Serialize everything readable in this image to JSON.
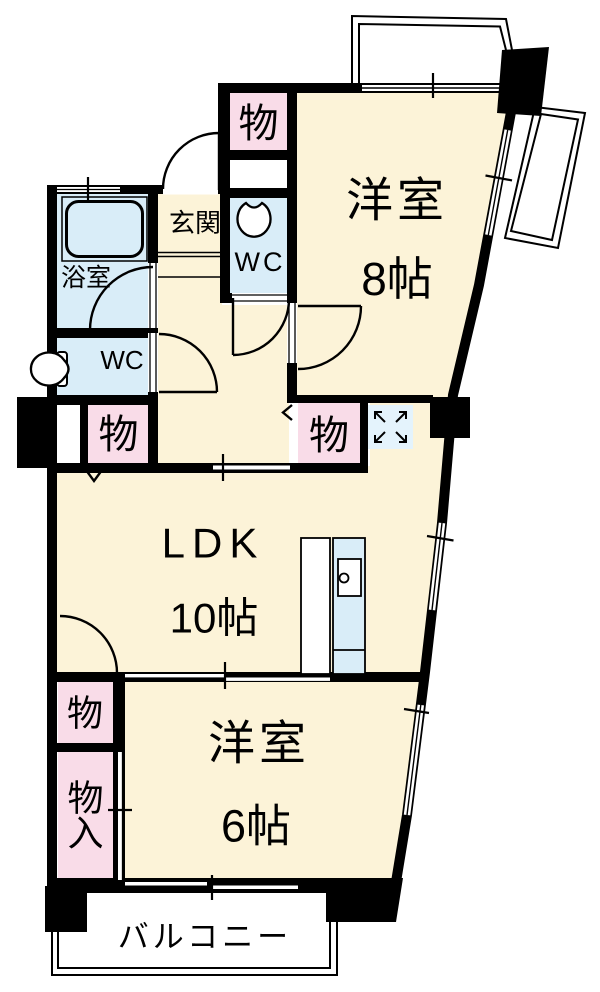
{
  "plan": {
    "type": "apartment-floor-plan",
    "colors": {
      "room_fill": "#FCF3D8",
      "wet_fill": "#D9EDF8",
      "storage_fill": "#F9DCE8",
      "vent_fill": "#E4F3FC",
      "wall": "#000000",
      "background": "#FFFFFF"
    },
    "rooms": {
      "western8": {
        "name": "洋室",
        "size": "8帖"
      },
      "ldk": {
        "name": "LDK",
        "size": "10帖"
      },
      "western6": {
        "name": "洋室",
        "size": "6帖"
      },
      "entrance": {
        "name": "玄関"
      },
      "bathroom": {
        "name": "浴室"
      },
      "toilet_top": {
        "name": "WC"
      },
      "toilet_left": {
        "name": "WC"
      },
      "balcony": {
        "name": "バルコニー"
      },
      "storage_top": {
        "name": "物"
      },
      "storage_hall": {
        "name": "物"
      },
      "storage_mid": {
        "name": "物"
      },
      "storage_south": {
        "name": "物"
      },
      "storage_in": {
        "name": "物入",
        "chars": [
          "物",
          "入"
        ]
      }
    }
  }
}
